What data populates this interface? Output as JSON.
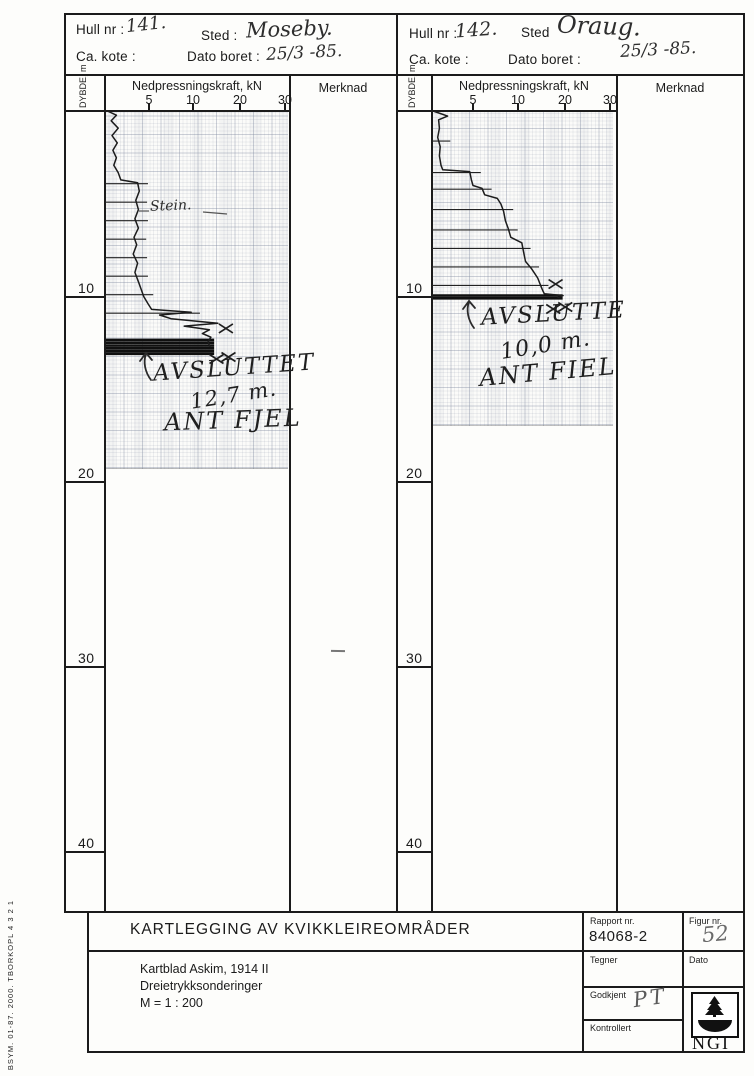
{
  "document": {
    "side_note": "BSYM. 01-87. 2000. TBORKOPL 4 3 2 1"
  },
  "panels": [
    {
      "hull_label": "Hull nr :",
      "hull_value": "141.",
      "sted_label": "Sted :",
      "sted_value": "Moseby.",
      "kote_label": "Ca. kote :",
      "dato_label": "Dato boret :",
      "dato_value": "25/3 -85.",
      "depth_axis_label": "DYBDE, m",
      "force_axis_label": "Nedpressningskraft, kN",
      "merknad_label": "Merknad",
      "ticks": [
        "5",
        "10",
        "20",
        "30"
      ],
      "depth_marks": [
        "10",
        "20",
        "30",
        "40"
      ],
      "note_stein": "Stein.",
      "avsluttet_1": "AVSLUTTET",
      "avsluttet_2": "12,7 m.",
      "avsluttet_3": "ANT FJEL"
    },
    {
      "hull_label": "Hull nr :",
      "hull_value": "142.",
      "sted_label": "Sted",
      "sted_value": "Oraug.",
      "kote_label": "Ca. kote :",
      "dato_label": "Dato boret :",
      "dato_value": "25/3 -85.",
      "depth_axis_label": "DYBDE, m",
      "force_axis_label": "Nedpressningskraft, kN",
      "merknad_label": "Merknad",
      "ticks": [
        "5",
        "10",
        "20",
        "30"
      ],
      "depth_marks": [
        "10",
        "20",
        "30",
        "40"
      ],
      "avsluttet_1": "AVSLUTTE",
      "avsluttet_2": "10,0 m.",
      "avsluttet_3": "ANT FIEL"
    }
  ],
  "title_block": {
    "title": "KARTLEGGING AV KVIKKLEIREOMRÅDER",
    "line1": "Kartblad Askim, 1914 II",
    "line2": "Dreietrykksonderinger",
    "line3": "M = 1 : 200",
    "rapport_label": "Rapport nr.",
    "rapport_value": "84068-2",
    "figur_label": "Figur nr.",
    "figur_value": "52",
    "tegner_label": "Tegner",
    "dato_label": "Dato",
    "godkjent_label": "Godkjent",
    "godkjent_value": "PT",
    "kontrollert_label": "Kontrollert",
    "logo_text": "NGI"
  },
  "chart_data": [
    {
      "type": "line",
      "title": "Hull nr. 141 — Moseby, dreietrykksondering",
      "xlabel": "Nedpressningskraft, kN",
      "ylabel": "DYBDE, m",
      "x_ticks": [
        5,
        10,
        20,
        30
      ],
      "xlim": [
        0,
        30
      ],
      "ylim": [
        0,
        43
      ],
      "y_axis_down": true,
      "terminated_depth_m": 12.7,
      "termination_note": "Avsluttet 12,7 m. Ant. fjell",
      "points": [
        [
          0,
          0.4
        ],
        [
          0.2,
          1.3
        ],
        [
          0.5,
          0.7
        ],
        [
          0.9,
          1.5
        ],
        [
          1.3,
          0.8
        ],
        [
          1.7,
          1.4
        ],
        [
          2.1,
          0.9
        ],
        [
          2.5,
          1.3
        ],
        [
          2.9,
          1.0
        ],
        [
          3.3,
          1.5
        ],
        [
          3.7,
          1.8
        ],
        [
          3.85,
          3.7
        ],
        [
          4.3,
          3.9
        ],
        [
          4.8,
          3.5
        ],
        [
          5.3,
          3.8
        ],
        [
          5.8,
          3.4
        ],
        [
          6.3,
          3.8
        ],
        [
          6.8,
          3.3
        ],
        [
          7.2,
          3.6
        ],
        [
          7.7,
          3.2
        ],
        [
          8.2,
          3.7
        ],
        [
          8.7,
          3.4
        ],
        [
          9.2,
          3.8
        ],
        [
          9.6,
          4.1
        ],
        [
          10.0,
          4.4
        ],
        [
          10.4,
          4.9
        ],
        [
          10.7,
          5.3
        ],
        [
          10.85,
          9.8
        ],
        [
          11.0,
          6.2
        ],
        [
          11.2,
          7.5
        ],
        [
          11.45,
          15.3
        ],
        [
          11.6,
          9.0
        ],
        [
          11.8,
          13.5
        ],
        [
          12.0,
          12.0
        ],
        [
          12.2,
          13.8
        ],
        [
          12.45,
          13.2
        ],
        [
          12.7,
          13.6
        ]
      ],
      "tick_lines": [
        {
          "d": 3.9,
          "kN": 4.2
        },
        {
          "d": 4.9,
          "kN": 4.1
        },
        {
          "d": 5.9,
          "kN": 4.2
        },
        {
          "d": 6.9,
          "kN": 4.0
        },
        {
          "d": 7.9,
          "kN": 4.1
        },
        {
          "d": 8.9,
          "kN": 4.2
        },
        {
          "d": 9.9,
          "kN": 4.8
        },
        {
          "d": 10.9,
          "kN": 10.2
        }
      ],
      "band": {
        "depths": [
          12.35,
          12.5,
          12.65,
          12.8,
          12.95,
          13.1
        ],
        "kN": 14.5
      },
      "x_marks": [
        {
          "d": 11.7,
          "kN": 17.0,
          "double": false
        },
        {
          "d": 13.35,
          "kN": 15.0,
          "double": true
        }
      ]
    },
    {
      "type": "line",
      "title": "Hull nr. 142 — Oraug, dreietrykksondering",
      "xlabel": "Nedpressningskraft, kN",
      "ylabel": "DYBDE, m",
      "x_ticks": [
        5,
        10,
        20,
        30
      ],
      "xlim": [
        0,
        30
      ],
      "ylim": [
        0,
        43
      ],
      "y_axis_down": true,
      "terminated_depth_m": 10.0,
      "termination_note": "Avsluttet 10,0 m. Ant. fjell",
      "points": [
        [
          0,
          0.3
        ],
        [
          0.25,
          1.9
        ],
        [
          0.45,
          0.8
        ],
        [
          0.9,
          0.9
        ],
        [
          1.4,
          0.7
        ],
        [
          1.9,
          1.0
        ],
        [
          2.4,
          0.9
        ],
        [
          2.9,
          1.1
        ],
        [
          3.15,
          1.3
        ],
        [
          3.25,
          4.6
        ],
        [
          3.7,
          4.8
        ],
        [
          4.0,
          5.0
        ],
        [
          4.15,
          6.0
        ],
        [
          4.5,
          6.3
        ],
        [
          4.7,
          7.7
        ],
        [
          5.0,
          8.1
        ],
        [
          5.4,
          8.4
        ],
        [
          5.9,
          8.6
        ],
        [
          6.3,
          8.9
        ],
        [
          6.8,
          9.2
        ],
        [
          7.1,
          10.8
        ],
        [
          7.6,
          11.2
        ],
        [
          8.1,
          11.6
        ],
        [
          8.5,
          12.9
        ],
        [
          9.0,
          14.2
        ],
        [
          9.4,
          14.8
        ],
        [
          9.7,
          15.3
        ],
        [
          9.85,
          15.6
        ],
        [
          9.95,
          19.6
        ],
        [
          10.05,
          18.5
        ]
      ],
      "tick_lines": [
        {
          "d": 1.6,
          "kN": 1.5
        },
        {
          "d": 3.3,
          "kN": 5.2
        },
        {
          "d": 4.2,
          "kN": 6.4
        },
        {
          "d": 5.3,
          "kN": 8.8
        },
        {
          "d": 6.4,
          "kN": 9.3
        },
        {
          "d": 7.4,
          "kN": 11.4
        },
        {
          "d": 8.4,
          "kN": 13.2
        },
        {
          "d": 9.4,
          "kN": 15.2
        }
      ],
      "band": {
        "depths": [
          9.95,
          10.1
        ],
        "kN": 19.5
      },
      "x_marks": [
        {
          "d": 9.3,
          "kN": 18.0,
          "double": false
        },
        {
          "d": 10.65,
          "kN": 17.5,
          "double": true
        }
      ]
    }
  ]
}
